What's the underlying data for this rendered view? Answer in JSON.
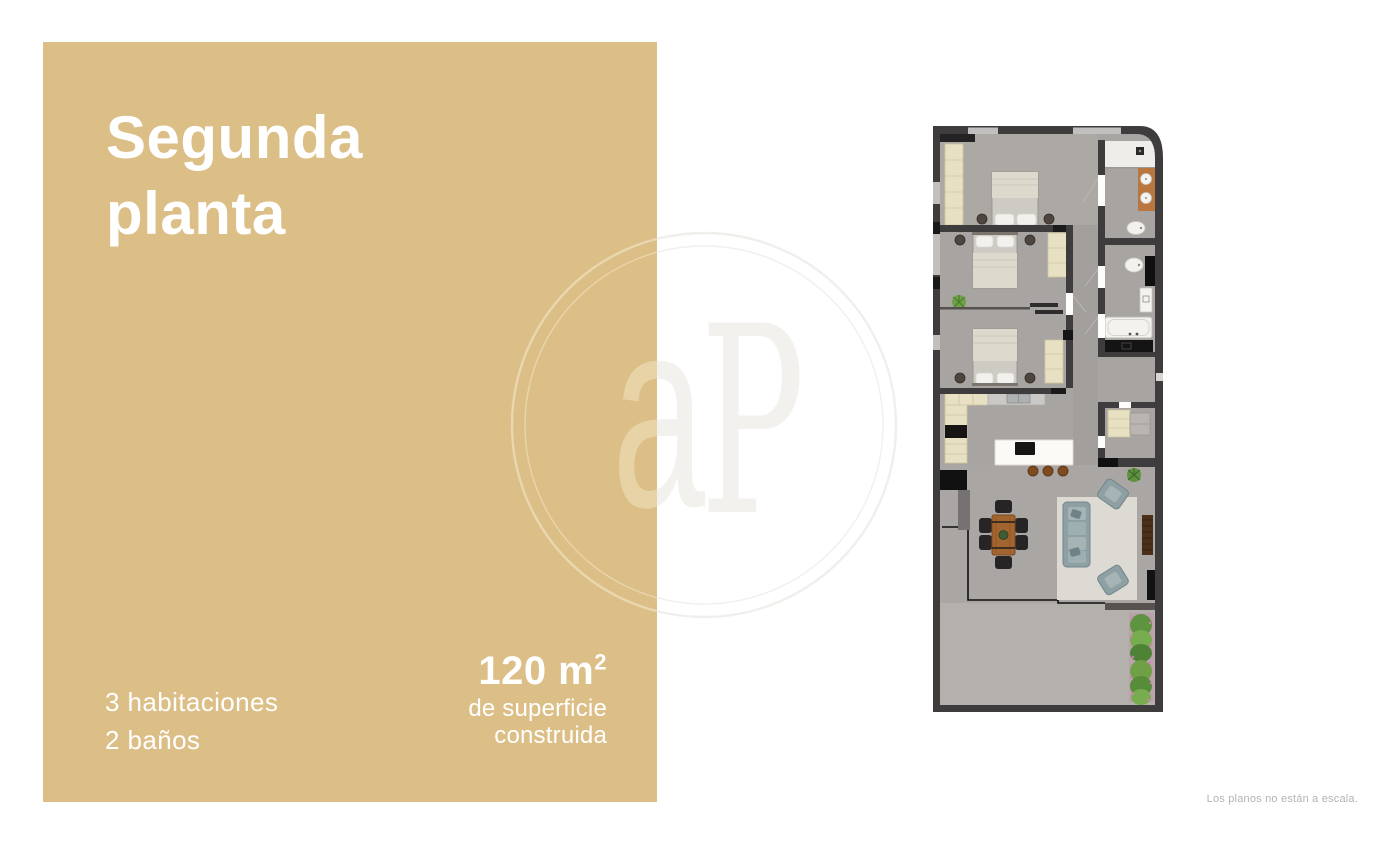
{
  "panel": {
    "background": "#DCBE87",
    "text_color": "#FFFFFF",
    "title_line1": "Segunda",
    "title_line2": "planta",
    "stat_line1": "3 habitaciones",
    "stat_line2": "2 baños",
    "area_value": "120 m",
    "area_sup": "2",
    "area_caption_line1": "de superficie",
    "area_caption_line2": "construida"
  },
  "watermark": {
    "letter_a": "a",
    "letter_p": "P",
    "color_on_panel": "#E9D5AB",
    "color_on_white": "#F2F0ED"
  },
  "floorplan": {
    "colors": {
      "wall": "#3F3C3E",
      "black_fixture": "#141313",
      "floor": "#A8A4A1",
      "terrace_floor": "#B4B0AC",
      "bath_white": "#F0EEEA",
      "furniture_cream": "#E8E0C3",
      "counter_gray": "#CBC9C5",
      "island_white": "#FBFAF7",
      "sofa": "#8FA0A4",
      "rug": "#DCDAD3",
      "wood_table": "#A2652F",
      "wood_vanity": "#B9773F",
      "plant_green": "#6FA045",
      "flower_pink": "#D37FB2"
    },
    "rooms": [
      "bedroom-1",
      "bedroom-2",
      "bedroom-3",
      "bathroom-1",
      "bathroom-2",
      "dressing-room",
      "kitchen",
      "living-dining-room",
      "terrace"
    ]
  },
  "footer": {
    "disclaimer": "Los planos no están a escala."
  }
}
